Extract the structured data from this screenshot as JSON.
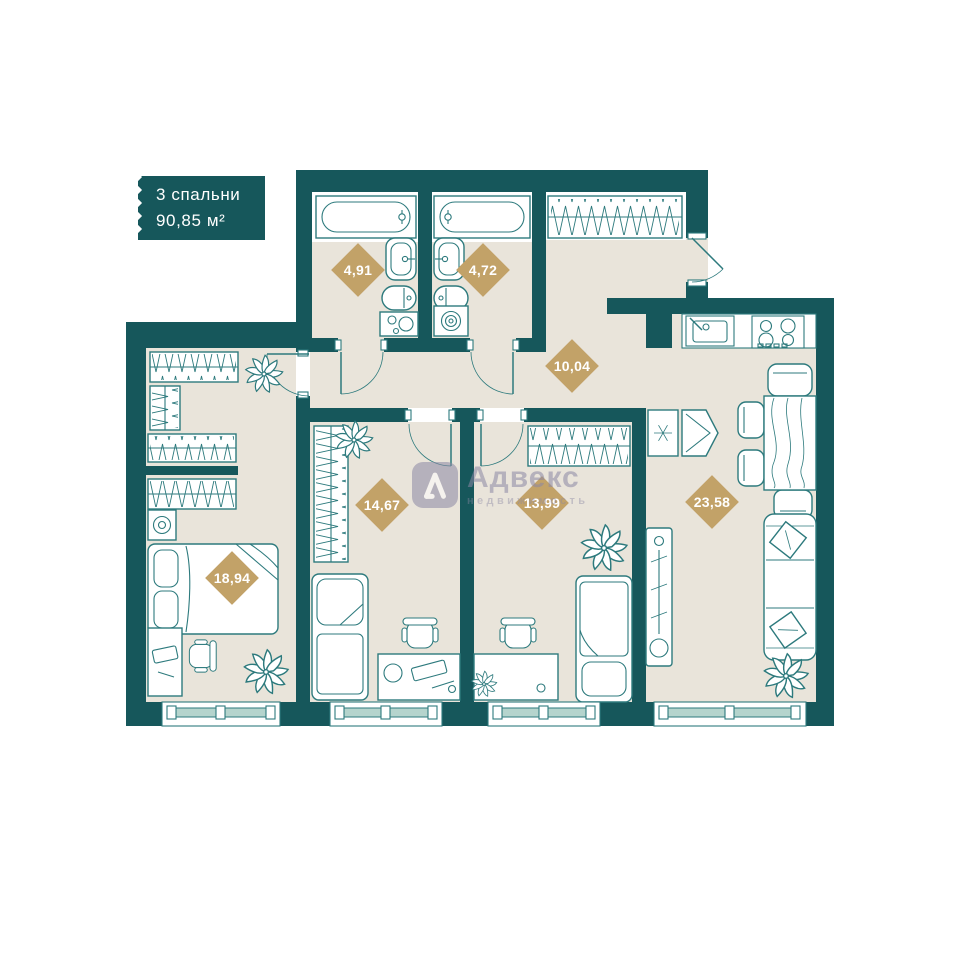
{
  "badge": {
    "title": "3 спальни",
    "area": "90,85 м²"
  },
  "rooms": [
    {
      "name": "bathroom-1",
      "area": "4,91"
    },
    {
      "name": "bathroom-2",
      "area": "4,72"
    },
    {
      "name": "hallway",
      "area": "10,04"
    },
    {
      "name": "bedroom-2",
      "area": "14,67"
    },
    {
      "name": "bedroom-3",
      "area": "13,99"
    },
    {
      "name": "kitchen-living-room",
      "area": "23,58"
    },
    {
      "name": "bedroom-1",
      "area": "18,94"
    }
  ],
  "watermark": {
    "brand": "Адвекс",
    "tagline": "недвижимость"
  },
  "colors": {
    "wall": "#16575b",
    "floor": "#e9e4da",
    "line": "#2d7a7d",
    "label": "#c2a268",
    "window_glass": "#b5d4cd",
    "badge_bg": "#16575b",
    "watermark": "#8c88a4"
  }
}
